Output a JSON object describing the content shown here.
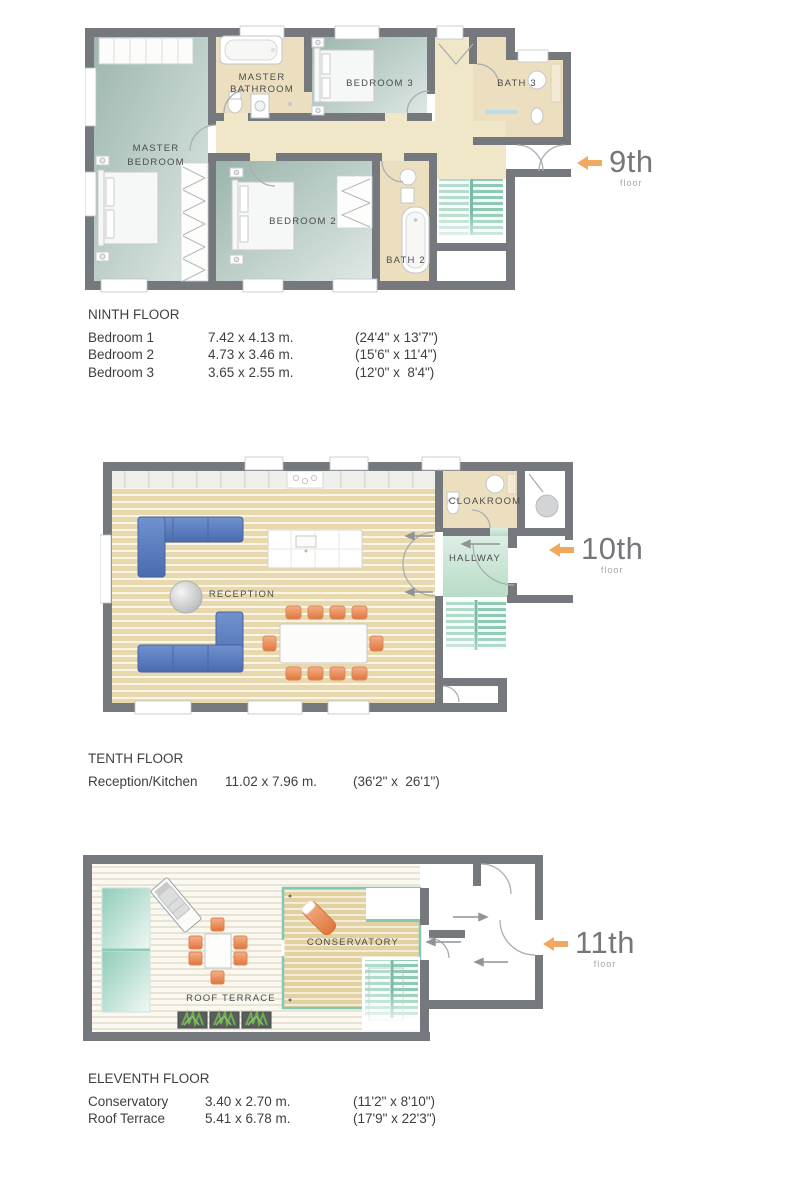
{
  "floors": [
    {
      "marker": {
        "number": "9th",
        "label": "floor"
      },
      "rooms": {
        "master_bathroom_l1": "MASTER",
        "master_bathroom_l2": "BATHROOM",
        "bedroom3": "BEDROOM 3",
        "bath3": "BATH 3",
        "master_bedroom_l1": "MASTER",
        "master_bedroom_l2": "BEDROOM",
        "bedroom2": "BEDROOM 2",
        "bath2": "BATH 2"
      },
      "table": {
        "title": "NINTH FLOOR",
        "rows": [
          {
            "name": "Bedroom 1",
            "metric": "7.42 x 4.13 m.",
            "imperial": "(24'4\" x 13'7\")"
          },
          {
            "name": "Bedroom 2",
            "metric": "4.73 x 3.46 m.",
            "imperial": "(15'6\" x 11'4\")"
          },
          {
            "name": "Bedroom 3",
            "metric": "3.65 x 2.55 m.",
            "imperial": "(12'0\" x  8'4\")"
          }
        ]
      }
    },
    {
      "marker": {
        "number": "10th",
        "label": "floor"
      },
      "rooms": {
        "cloakroom": "CLOAKROOM",
        "hallway": "HALLWAY",
        "reception": "RECEPTION"
      },
      "table": {
        "title": "TENTH FLOOR",
        "rows": [
          {
            "name": "Reception/Kitchen",
            "metric": "11.02 x 7.96 m.",
            "imperial": "(36'2\" x  26'1\")"
          }
        ]
      }
    },
    {
      "marker": {
        "number": "11th",
        "label": "floor"
      },
      "rooms": {
        "conservatory": "CONSERVATORY",
        "roof_terrace": "ROOF TERRACE"
      },
      "table": {
        "title": "ELEVENTH FLOOR",
        "rows": [
          {
            "name": "Conservatory",
            "metric": "3.40 x 2.70 m.",
            "imperial": "(11'2\" x 8'10\")"
          },
          {
            "name": "Roof Terrace",
            "metric": "5.41 x 6.78 m.",
            "imperial": "(17'9\" x 22'3\")"
          }
        ]
      }
    }
  ],
  "colors": {
    "wall": "#75797d",
    "carpet": "#a9c0ba",
    "tile": "#ecdfc0",
    "wood": "#e8d9b0",
    "stairs": "#8ecab3",
    "hallway": "#cfe7da",
    "sofa": "#5d80c3",
    "chair": "#ec8a55",
    "glass": "#9dd3bf",
    "arrow": "#f1a95f",
    "floor_number": "#76777a",
    "label_text": "#4b4c4e",
    "spec_text": "#3e3f41"
  }
}
